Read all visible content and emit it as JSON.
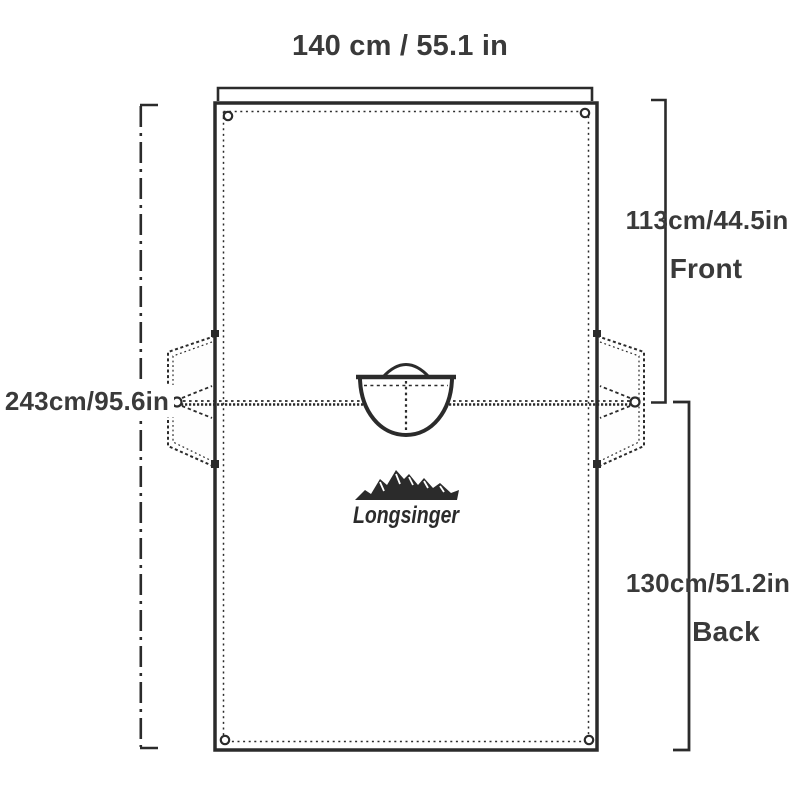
{
  "colors": {
    "line": "#2b2b2b",
    "text": "#3a3a3a",
    "background": "#ffffff"
  },
  "diagram": {
    "top_width_label": "140 cm / 55.1 in",
    "front_dimension": "113cm/44.5in",
    "front_label": "Front",
    "total_height": "243cm/95.6in",
    "back_dimension": "130cm/51.2in",
    "back_label": "Back",
    "brand": "Longsinger"
  }
}
